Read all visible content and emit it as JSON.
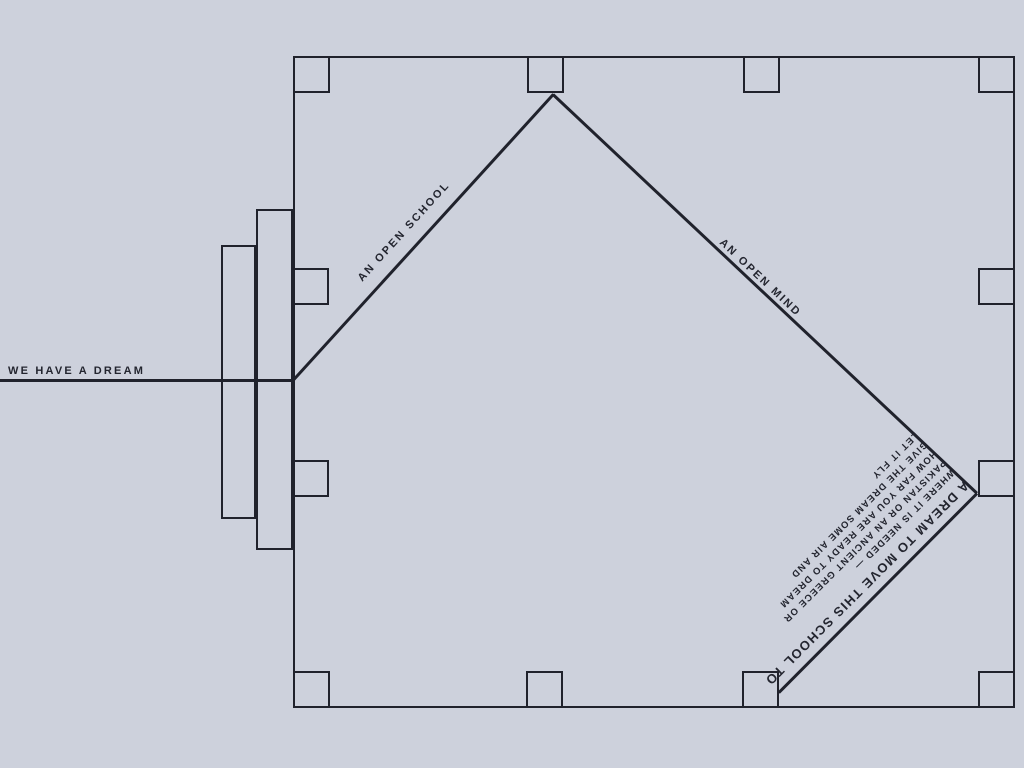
{
  "palette": {
    "background": "#cdd1dc",
    "line": "#20222c",
    "text": "#23252f"
  },
  "labels": {
    "dream": "WE HAVE A DREAM",
    "open_school": "AN OPEN SCHOOL",
    "open_mind": "AN OPEN MIND"
  },
  "dream_block": {
    "headline": "A DREAM TO MOVE THIS SCHOOL TO",
    "lines": [
      "WHERE IT IS NEEDED —",
      "PAKISTAN OR AN ANCIENT GREECE OR",
      "HOW FAR YOU ARE READY TO DREAM",
      "GIVE THE DREAM SOME AIR AND",
      "LET IT FLY"
    ]
  }
}
